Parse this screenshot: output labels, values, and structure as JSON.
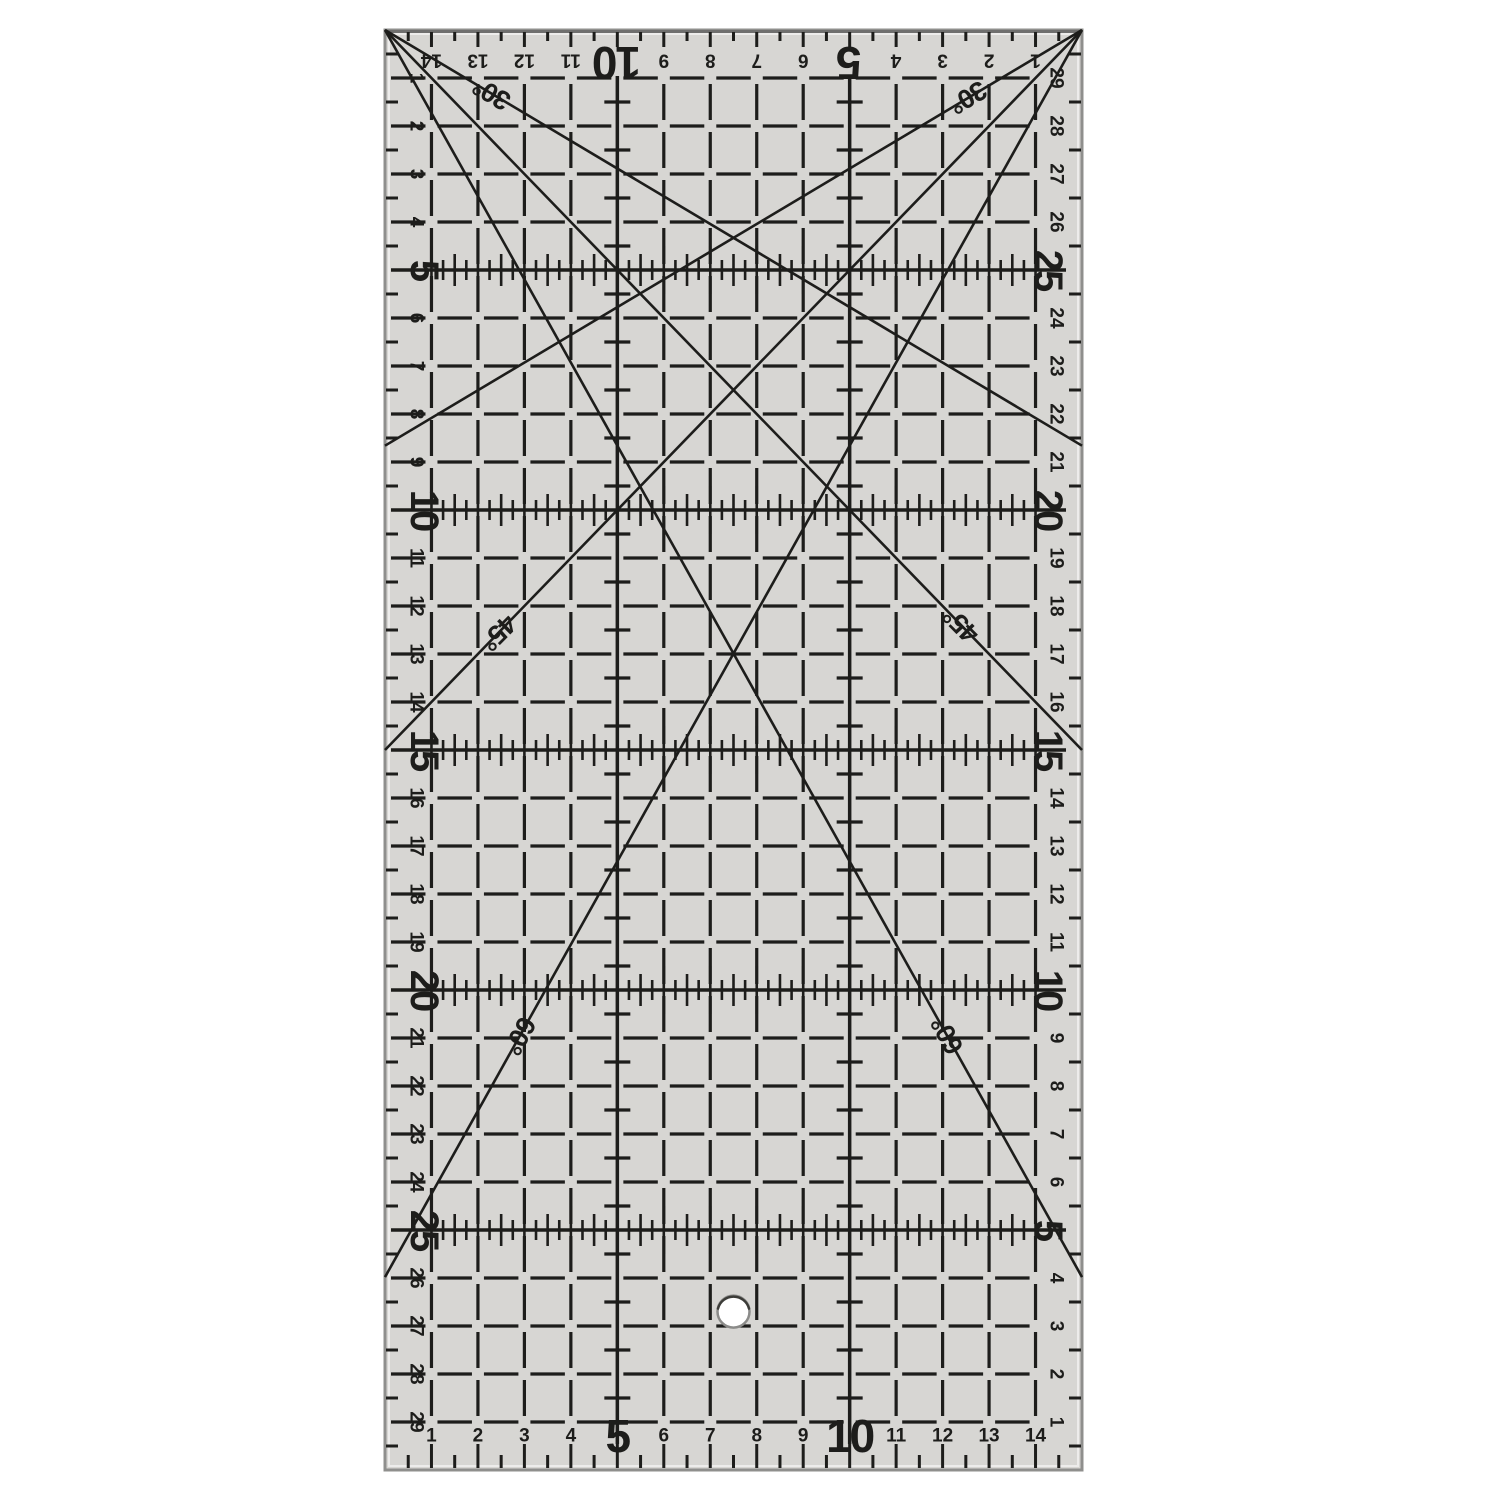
{
  "image_type": "product photo of a transparent acrylic quilting / patchwork ruler on a plain white background",
  "colors": {
    "background": "#ffffff",
    "ruler_body": "#d7d6d3",
    "print": "#1d1d1b",
    "edge": "#8f8f8d",
    "edge_highlight": "rgba(255,255,255,0.55)",
    "hole_fill": "#ffffff",
    "hole_rim": "#8b8b89",
    "hole_rim_dark": "#3c3c38"
  },
  "ruler": {
    "width_cm": 15,
    "height_cm": 30,
    "scales": {
      "top": {
        "orientation": "upside-down, numbered right-to-left from top-right corner",
        "numbers": [
          1,
          2,
          3,
          4,
          5,
          6,
          7,
          8,
          9,
          10,
          11,
          12,
          13,
          14
        ],
        "bold_numbers": [
          5,
          10
        ]
      },
      "bottom": {
        "orientation": "upright, numbered left-to-right from bottom-left corner",
        "numbers": [
          1,
          2,
          3,
          4,
          5,
          6,
          7,
          8,
          9,
          10,
          11,
          12,
          13,
          14
        ],
        "bold_numbers": [
          5,
          10
        ]
      },
      "left": {
        "orientation": "rotated 90°, numbered top-to-bottom",
        "numbers": [
          1,
          2,
          3,
          4,
          5,
          6,
          7,
          8,
          9,
          10,
          11,
          12,
          13,
          14,
          15,
          16,
          17,
          18,
          19,
          20,
          21,
          22,
          23,
          24,
          25,
          26,
          27,
          28,
          29
        ],
        "bold_numbers": [
          5,
          10,
          15,
          20,
          25
        ]
      },
      "right": {
        "orientation": "rotated 90°, numbered bottom-to-top",
        "numbers": [
          1,
          2,
          3,
          4,
          5,
          6,
          7,
          8,
          9,
          10,
          11,
          12,
          13,
          14,
          15,
          16,
          17,
          18,
          19,
          20,
          21,
          22,
          23,
          24,
          25,
          26,
          27,
          28,
          29
        ],
        "bold_numbers": [
          5,
          10,
          15,
          20,
          25
        ]
      }
    },
    "grid": {
      "cell_cm": 1,
      "dashed_grid": true,
      "solid_tick_rows_cm": [
        5,
        10,
        15,
        20,
        25
      ],
      "solid_cross_columns_cm": [
        5,
        10
      ]
    },
    "angle_lines": [
      {
        "label": "30°",
        "angle_deg": 30,
        "origin": "top-left"
      },
      {
        "label": "45°",
        "angle_deg": 45,
        "origin": "top-left"
      },
      {
        "label": "60°",
        "angle_deg": 60,
        "origin": "top-left"
      },
      {
        "label": "30°",
        "angle_deg": 30,
        "origin": "top-right"
      },
      {
        "label": "45°",
        "angle_deg": 45,
        "origin": "top-right"
      },
      {
        "label": "60°",
        "angle_deg": 60,
        "origin": "top-right"
      }
    ],
    "hole": {
      "x_cm": 7.5,
      "y_cm": 26.7
    }
  }
}
